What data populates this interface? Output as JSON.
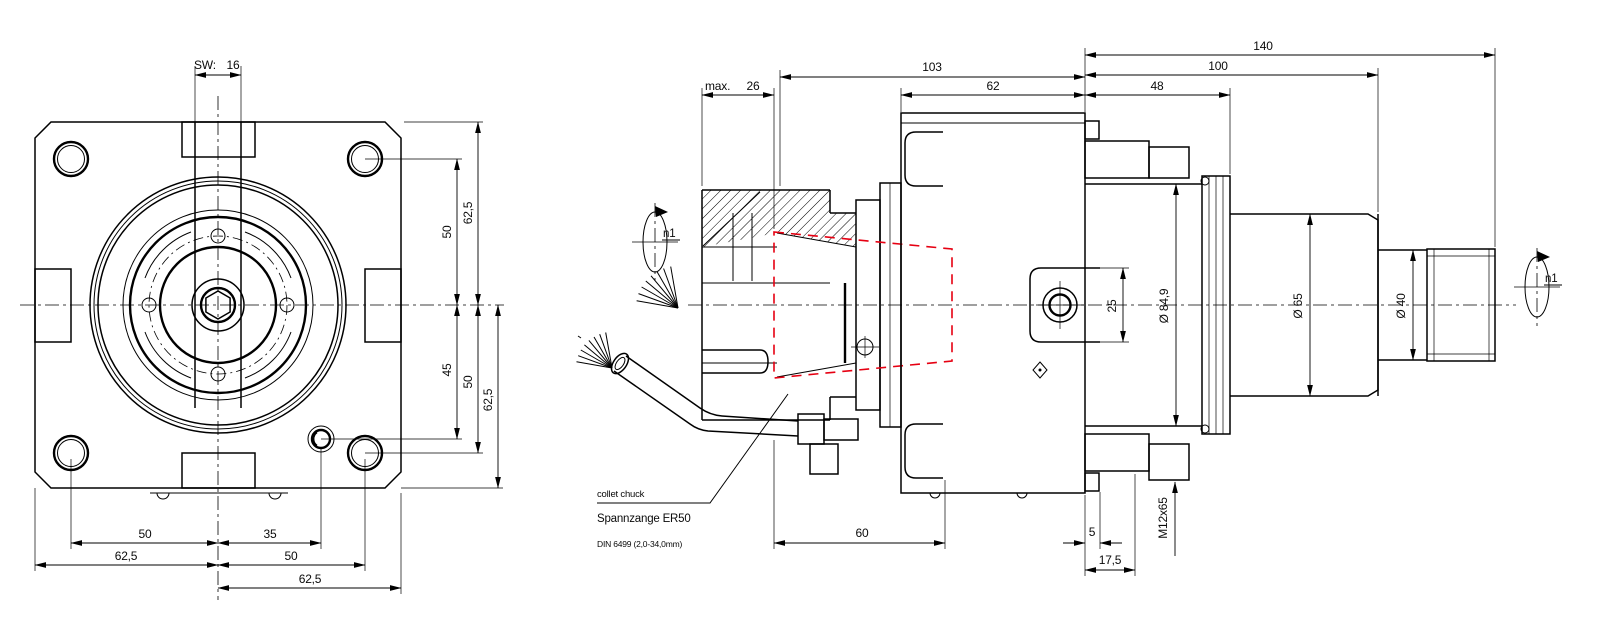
{
  "colors": {
    "line": "#000000",
    "accent_red": "#e60012",
    "background": "#ffffff"
  },
  "front_view": {
    "wrench_dim": {
      "prefix": "SW:",
      "value": "16"
    },
    "right_dims": {
      "top_50": "50",
      "top_62_5": "62,5",
      "bottom_45": "45",
      "bottom_50": "50",
      "bottom_62_5": "62,5"
    },
    "bottom_dims": {
      "row1_left_50": "50",
      "row1_right_35": "35",
      "row2_left_62_5": "62,5",
      "row2_right_50": "50",
      "row3_62_5": "62,5"
    }
  },
  "side_view": {
    "top_dims": {
      "max_prefix": "max.",
      "max_value": "26",
      "overall_103": "103",
      "body_62": "62",
      "shaft_140": "140",
      "shaft_100": "100",
      "rear_48": "48"
    },
    "bottom_dims": {
      "front_60": "60",
      "gap_5": "5",
      "offset_17_5": "17,5",
      "thread": "M12x65"
    },
    "diameter_dims": {
      "dia_84_9": "Ø 84,9",
      "tab_25": "25",
      "dia_65": "Ø 65",
      "dia_40": "Ø 40"
    },
    "rotation": {
      "left": "n1",
      "right": "n1"
    },
    "callout": {
      "line1": "collet chuck",
      "line2": "Spannzange ER50",
      "line3": "DIN 6499 (2,0-34,0mm)"
    }
  }
}
